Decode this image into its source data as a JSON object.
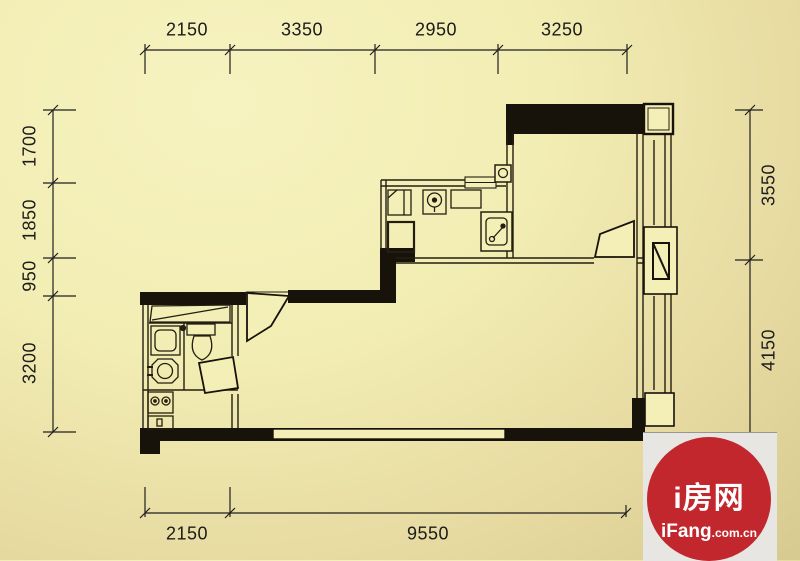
{
  "dimensions": {
    "top": [
      "2150",
      "3350",
      "2950",
      "3250"
    ],
    "left": [
      "1700",
      "1850",
      "950",
      "3200"
    ],
    "right": [
      "3550",
      "4150"
    ],
    "bottom": [
      "2150",
      "9550"
    ]
  },
  "watermark": {
    "brand": "i房网",
    "site": "iFang",
    "suffix": ".com.cn"
  },
  "colors": {
    "background_light": "#f6f2bc",
    "background_dark": "#d7ca90",
    "wall_fill": "#17120a",
    "thin_line": "#241e10",
    "dimension_text": "#1b1b1b",
    "watermark_red": "#c1272d",
    "watermark_panel": "#e8e6e2"
  }
}
